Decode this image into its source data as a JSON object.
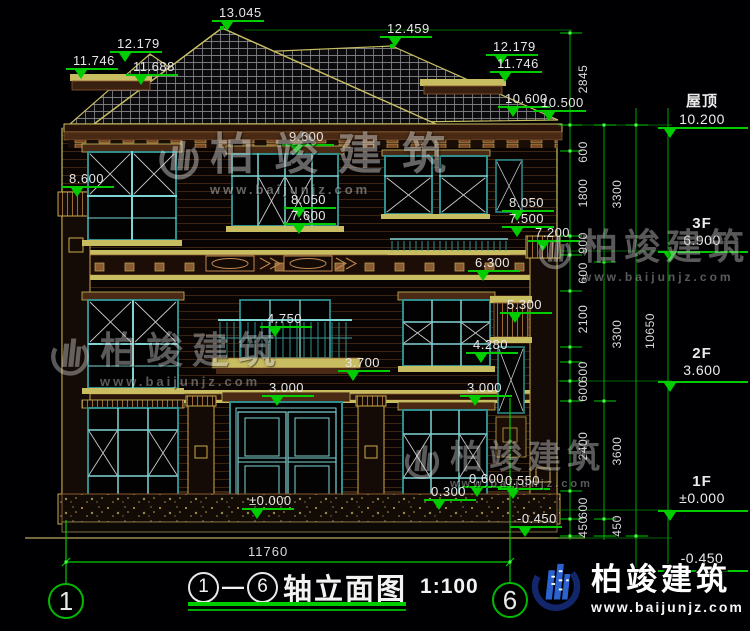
{
  "colors": {
    "dim_green": "#00cc00",
    "text_white": "#e7e7e7",
    "trim_yellow": "#c9bd62",
    "frame_teal": "#2f8f8f",
    "mullion_cyan": "#7fd4d4",
    "logo_blue": "#2b62d0",
    "logo_navy": "#12266b"
  },
  "title": {
    "axis_from": "1",
    "dash": "—",
    "axis_to": "6",
    "text": "轴立面图",
    "scale": "1:100"
  },
  "bottom": {
    "width_dim": "11760",
    "axis_left": "1",
    "axis_right": "6"
  },
  "brand": {
    "name": "柏竣建筑",
    "url": "www.baijunjz.com"
  },
  "watermark": {
    "text": "柏竣建筑",
    "url": "www.baijunjz.com",
    "instances": [
      {
        "x": 156,
        "y": 118,
        "size": 44,
        "ls": 20,
        "url_size": 13,
        "opacity": 0.5,
        "logo_w": 46
      },
      {
        "x": 48,
        "y": 320,
        "size": 37,
        "ls": 9,
        "url_size": 13,
        "opacity": 0.45,
        "logo_w": 44
      },
      {
        "x": 536,
        "y": 218,
        "size": 36,
        "ls": 6,
        "url_size": 12,
        "opacity": 0.45,
        "logo_w": 38
      },
      {
        "x": 402,
        "y": 430,
        "size": 33,
        "ls": 6,
        "url_size": 11,
        "opacity": 0.45,
        "logo_w": 40
      }
    ]
  },
  "elevation_labels": [
    {
      "text": "13.045",
      "x": 212,
      "y": 6
    },
    {
      "text": "12.179",
      "x": 110,
      "y": 37
    },
    {
      "text": "11.746",
      "x": 66,
      "y": 54
    },
    {
      "text": "11.688",
      "x": 126,
      "y": 60
    },
    {
      "text": "12.459",
      "x": 380,
      "y": 22
    },
    {
      "text": "12.179",
      "x": 486,
      "y": 40
    },
    {
      "text": "11.746",
      "x": 490,
      "y": 57
    },
    {
      "text": "10.600",
      "x": 498,
      "y": 92
    },
    {
      "text": "10.500",
      "x": 534,
      "y": 96
    },
    {
      "text": "9.600",
      "x": 282,
      "y": 130
    },
    {
      "text": "8.600",
      "x": 62,
      "y": 172
    },
    {
      "text": "8.050",
      "x": 284,
      "y": 193
    },
    {
      "text": "7.600",
      "x": 284,
      "y": 209
    },
    {
      "text": "8.050",
      "x": 502,
      "y": 196
    },
    {
      "text": "7.500",
      "x": 502,
      "y": 212
    },
    {
      "text": "7.200",
      "x": 528,
      "y": 226
    },
    {
      "text": "6.300",
      "x": 468,
      "y": 256
    },
    {
      "text": "5.300",
      "x": 500,
      "y": 298
    },
    {
      "text": "4.750",
      "x": 260,
      "y": 312
    },
    {
      "text": "4.280",
      "x": 466,
      "y": 338
    },
    {
      "text": "3.700",
      "x": 338,
      "y": 356
    },
    {
      "text": "3.000",
      "x": 262,
      "y": 381
    },
    {
      "text": "3.000",
      "x": 460,
      "y": 381
    },
    {
      "text": "0.600",
      "x": 462,
      "y": 472
    },
    {
      "text": "0.550",
      "x": 498,
      "y": 474
    },
    {
      "text": "0.300",
      "x": 424,
      "y": 485
    },
    {
      "text": "±0.000",
      "x": 242,
      "y": 494
    },
    {
      "text": "-0.450",
      "x": 510,
      "y": 512
    }
  ],
  "floor_markers": [
    {
      "label": "屋顶",
      "value": "10.200",
      "text_y": 90,
      "line_y": 127
    },
    {
      "label": "3F",
      "value": "6.900",
      "text_y": 215,
      "line_y": 251
    },
    {
      "label": "2F",
      "value": "3.600",
      "text_y": 345,
      "line_y": 381
    },
    {
      "label": "1F",
      "value": "±0.000",
      "text_y": 473,
      "line_y": 510
    },
    {
      "label": "",
      "value": "-0.450",
      "text_y": 550,
      "line_y": 570
    }
  ],
  "dim_chains": [
    {
      "x": 583,
      "items": [
        {
          "text": "2845",
          "y": 79
        },
        {
          "text": "600",
          "y": 152
        },
        {
          "text": "1800",
          "y": 193
        },
        {
          "text": "900",
          "y": 243
        },
        {
          "text": "600",
          "y": 273
        },
        {
          "text": "2100",
          "y": 319
        },
        {
          "text": "600",
          "y": 372
        },
        {
          "text": "600",
          "y": 391
        },
        {
          "text": "2400",
          "y": 446
        },
        {
          "text": "600",
          "y": 508
        },
        {
          "text": "450",
          "y": 527
        }
      ]
    },
    {
      "x": 617,
      "items": [
        {
          "text": "3300",
          "y": 194
        },
        {
          "text": "3300",
          "y": 334
        },
        {
          "text": "3600",
          "y": 451
        },
        {
          "text": "450",
          "y": 526
        }
      ]
    },
    {
      "x": 650,
      "items": [
        {
          "text": "10650",
          "y": 331
        }
      ]
    }
  ]
}
